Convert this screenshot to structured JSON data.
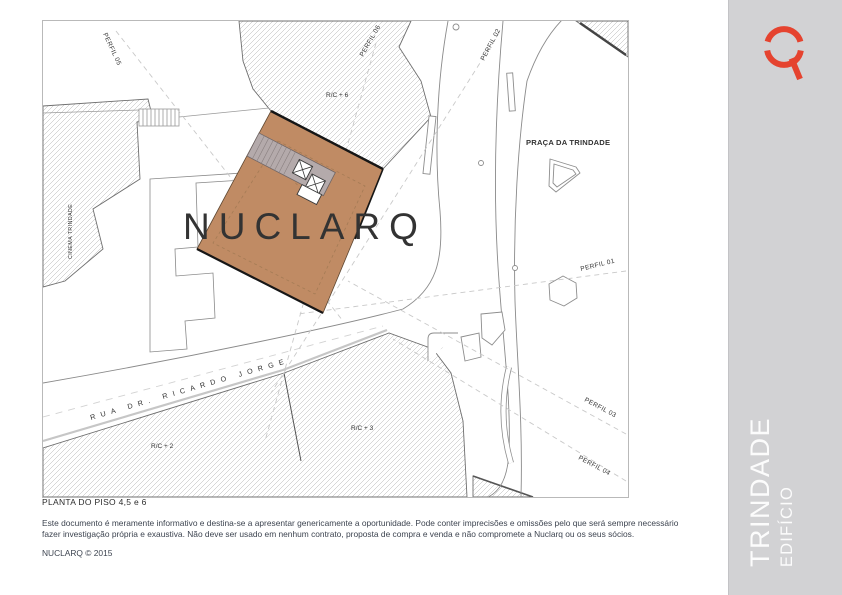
{
  "plan": {
    "caption": "PLANTA DO PISO 4,5 e 6",
    "watermark": "NUCLARQ",
    "labels": {
      "perfil_01": "PERFIL 01",
      "perfil_02": "PERFIL 02",
      "perfil_03": "PERFIL 03",
      "perfil_04": "PERFIL 04",
      "perfil_05": "PERFIL 05",
      "perfil_06": "PERFIL 06",
      "rc_plus_6": "R/C + 6",
      "rc_plus_2": "R/C + 2",
      "rc_plus_3": "R/C + 3",
      "cinema": "CINEMA TRINDADE",
      "praca": "PRAÇA DA TRINDADE",
      "street": "RUA DR. RICARDO JORGE"
    },
    "colors": {
      "building_highlight": "#C08B64",
      "core_gray": "#B4AAAB",
      "hatch_line": "#B0B0B0"
    }
  },
  "footer": {
    "disclaimer_line1": "Este documento é meramente informativo e destina-se a apresentar genericamente a oportunidade. Pode conter imprecisões e omissões pelo que será sempre necessário",
    "disclaimer_line2": "fazer investigação própria e exaustiva. Não deve ser usado em nenhum contrato, proposta de compra e venda e não compromete a Nuclarq ou os seus sócios.",
    "copyright": "NUCLARQ © 2015"
  },
  "sidebar": {
    "title": "TRINDADE",
    "subtitle": "EDIFÍCIO",
    "bg": "#D2D2D4",
    "logo_color": "#E5432F",
    "logo_name": "nuclarq-q-logo"
  }
}
